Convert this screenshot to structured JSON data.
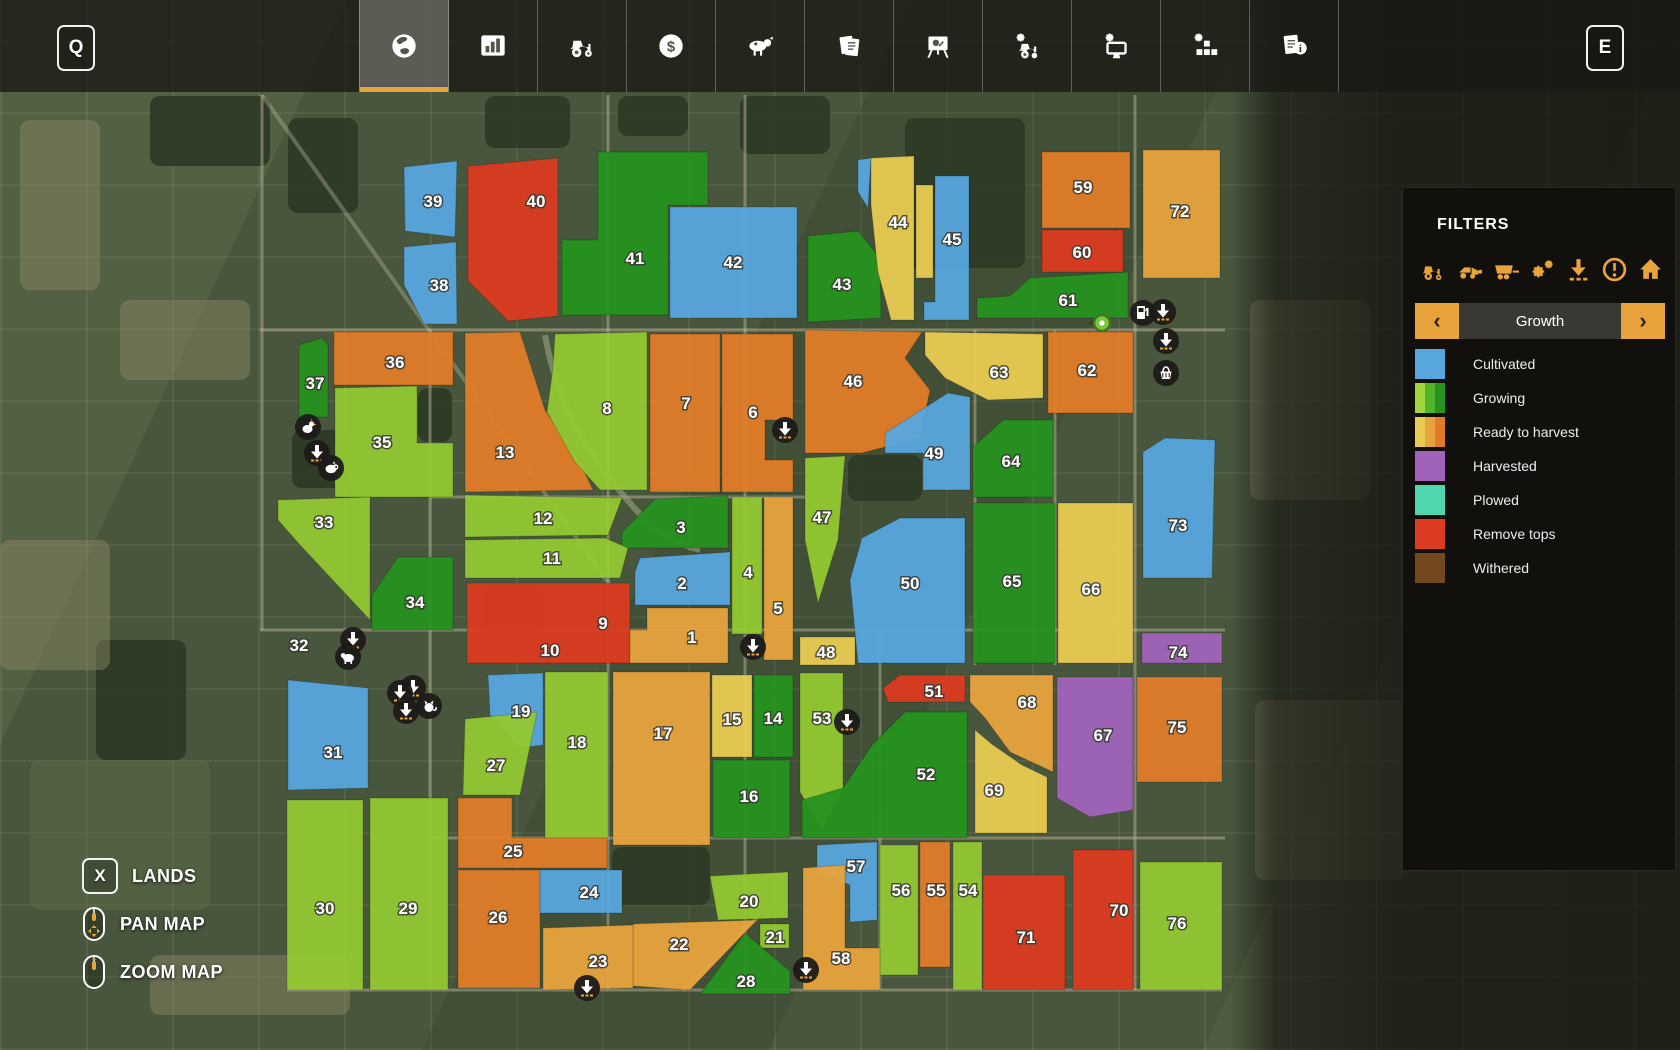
{
  "hotkeys": {
    "map": "Q",
    "menu": "E",
    "lands": "X"
  },
  "topbar": {
    "tabs": [
      {
        "icon": "globe",
        "active": true
      },
      {
        "icon": "bar-chart",
        "active": false
      },
      {
        "icon": "tractor",
        "active": false
      },
      {
        "icon": "dollar",
        "active": false
      },
      {
        "icon": "cow",
        "active": false
      },
      {
        "icon": "documents",
        "active": false
      },
      {
        "icon": "easel-chart",
        "active": false
      },
      {
        "icon": "tractor-gear",
        "active": false
      },
      {
        "icon": "monitor-gear",
        "active": false
      },
      {
        "icon": "blocks-gear",
        "active": false
      },
      {
        "icon": "document-info",
        "active": false
      }
    ]
  },
  "filters_panel": {
    "title": "FILTERS",
    "filter_icons": [
      "tractor",
      "loader",
      "trailer",
      "gears",
      "download",
      "alert",
      "house"
    ],
    "selector": {
      "label": "Growth",
      "prev": "‹",
      "next": "›"
    },
    "legend": [
      {
        "label": "Cultivated",
        "swatch": [
          "#57A7DE"
        ]
      },
      {
        "label": "Growing",
        "swatch": [
          "#9ED63B",
          "#52B42A",
          "#26921F"
        ]
      },
      {
        "label": "Ready to harvest",
        "swatch": [
          "#E9CB52",
          "#E8A33D",
          "#E07C28"
        ]
      },
      {
        "label": "Harvested",
        "swatch": [
          "#A163B9"
        ]
      },
      {
        "label": "Plowed",
        "swatch": [
          "#4FD6AE"
        ]
      },
      {
        "label": "Remove tops",
        "swatch": [
          "#DB3B20"
        ]
      },
      {
        "label": "Withered",
        "swatch": [
          "#74481F"
        ]
      }
    ]
  },
  "controls": [
    {
      "key": "X",
      "mouse": null,
      "label": "LANDS"
    },
    {
      "key": null,
      "mouse": "pan",
      "label": "PAN MAP"
    },
    {
      "key": null,
      "mouse": "zoom",
      "label": "ZOOM MAP"
    }
  ],
  "colors": {
    "cultivated": "#57A7DE",
    "growing_early": "#93C832",
    "growing_late": "#26921F",
    "ready_yellow": "#E9CB52",
    "ready_amber": "#E8A33D",
    "ready_orange": "#E07C28",
    "harvested": "#A163B9",
    "plowed": "#4FD6AE",
    "remove_tops": "#DB3B20",
    "withered": "#74481F",
    "accent": "#E8A33D"
  },
  "map": {
    "fields": [
      {
        "n": "39",
        "state": "cultivated",
        "d": "M404,167 L457,161 L455,237 L405,231 Z",
        "lp": [
          433,
          201
        ]
      },
      {
        "n": "38",
        "state": "cultivated",
        "d": "M404,247 L456,242 L457,324 L424,324 L404,285 Z",
        "lp": [
          439,
          285
        ]
      },
      {
        "n": "40",
        "state": "remove_tops",
        "d": "M468,166 L558,158 L558,316 L508,321 L468,281 Z",
        "lp": [
          536,
          201
        ]
      },
      {
        "n": "41",
        "state": "growing_late",
        "d": "M598,152 L708,152 L708,205 L668,205 L668,315 L562,315 L562,240 L598,240 Z",
        "lp": [
          635,
          258
        ]
      },
      {
        "n": "42",
        "state": "cultivated",
        "d": "M670,207 L797,207 L797,318 L670,318 Z",
        "lp": [
          733,
          262
        ]
      },
      {
        "n": "43",
        "state": "growing_late",
        "d": "M808,236 L858,231 L880,258 L881,318 L808,322 Z",
        "lp": [
          842,
          284
        ]
      },
      {
        "n": "44",
        "state": "ready_yellow",
        "d": "M871,158 L914,156 L914,320 L891,320 L878,272 L871,205 Z",
        "lp": [
          898,
          222
        ]
      },
      {
        "n": "",
        "state": "ready_yellow",
        "d": "M916,185 L933,185 L933,278 L916,278 Z",
        "lp": null
      },
      {
        "n": "45",
        "state": "cultivated",
        "d": "M935,176 L969,176 L969,320 L924,320 L924,302 L935,302 Z",
        "lp": [
          952,
          239
        ]
      },
      {
        "n": "",
        "state": "cultivated",
        "d": "M858,160 L871,158 L868,208 L858,192 Z",
        "lp": null
      },
      {
        "n": "59",
        "state": "ready_orange",
        "d": "M1042,152 L1130,152 L1130,228 L1042,228 Z",
        "lp": [
          1083,
          187
        ]
      },
      {
        "n": "60",
        "state": "remove_tops",
        "d": "M1042,230 L1123,230 L1123,272 L1042,272 Z",
        "lp": [
          1082,
          252
        ]
      },
      {
        "n": "61",
        "state": "growing_late",
        "d": "M977,298 L1010,296 L1030,278 L1128,272 L1128,318 L977,318 Z",
        "lp": [
          1068,
          300
        ]
      },
      {
        "n": "72",
        "state": "ready_amber",
        "d": "M1143,150 L1220,150 L1220,278 L1143,278 Z",
        "lp": [
          1180,
          211
        ]
      },
      {
        "n": "36",
        "state": "ready_orange",
        "d": "M334,332 L453,332 L453,385 L334,385 Z",
        "lp": [
          395,
          362
        ]
      },
      {
        "n": "37",
        "state": "growing_late",
        "d": "M299,345 L322,338 L328,345 L328,417 L299,417 Z",
        "lp": [
          315,
          383
        ]
      },
      {
        "n": "35",
        "state": "growing_early",
        "d": "M335,388 L417,386 L417,443 L453,443 L453,497 L335,497 Z",
        "lp": [
          382,
          442
        ]
      },
      {
        "n": "33",
        "state": "growing_early",
        "d": "M278,500 L370,497 L370,620 L300,545 L278,520 Z",
        "lp": [
          324,
          522
        ]
      },
      {
        "n": "34",
        "state": "growing_late",
        "d": "M372,595 L398,557 L453,557 L453,630 L372,630 Z",
        "lp": [
          415,
          602
        ]
      },
      {
        "n": "13",
        "state": "ready_orange",
        "d": "M465,333 L520,332 L545,410 L580,462 L593,490 L465,492 Z",
        "lp": [
          505,
          452
        ]
      },
      {
        "n": "8",
        "state": "growing_early",
        "d": "M555,334 L647,332 L647,490 L600,490 L575,462 L547,412 L553,368 Z",
        "lp": [
          607,
          408
        ]
      },
      {
        "n": "7",
        "state": "ready_orange",
        "d": "M650,334 L720,334 L720,492 L650,492 Z",
        "lp": [
          686,
          403
        ]
      },
      {
        "n": "6",
        "state": "ready_orange",
        "d": "M722,334 L793,334 L793,420 L765,420 L765,460 L793,460 L793,492 L722,492 Z",
        "lp": [
          753,
          412
        ]
      },
      {
        "n": "46",
        "state": "ready_orange",
        "d": "M805,330 L922,332 L905,358 L930,390 L920,438 L862,453 L805,453 Z",
        "lp": [
          853,
          381
        ]
      },
      {
        "n": "63",
        "state": "ready_yellow",
        "d": "M925,332 L1043,334 L1043,398 L988,400 L945,378 L925,355 Z",
        "lp": [
          999,
          372
        ]
      },
      {
        "n": "62",
        "state": "ready_orange",
        "d": "M1048,332 L1133,332 L1133,413 L1048,413 Z",
        "lp": [
          1087,
          370
        ]
      },
      {
        "n": "47",
        "state": "growing_early",
        "d": "M805,458 L845,456 L838,540 L818,603 L805,540 Z",
        "lp": [
          822,
          517
        ]
      },
      {
        "n": "49",
        "state": "cultivated",
        "d": "M948,393 L970,397 L970,490 L923,490 L923,453 L885,453 L885,433 Z",
        "lp": [
          934,
          453
        ]
      },
      {
        "n": "64",
        "state": "growing_late",
        "d": "M973,447 L1003,420 L1053,420 L1053,497 L973,497 Z",
        "lp": [
          1011,
          461
        ]
      },
      {
        "n": "50",
        "state": "cultivated",
        "d": "M862,538 L900,518 L965,518 L965,663 L858,663 L850,580 Z",
        "lp": [
          910,
          583
        ]
      },
      {
        "n": "65",
        "state": "growing_late",
        "d": "M973,503 L1055,503 L1055,663 L973,663 Z",
        "lp": [
          1012,
          581
        ]
      },
      {
        "n": "66",
        "state": "ready_yellow",
        "d": "M1058,503 L1133,503 L1133,663 L1058,663 Z",
        "lp": [
          1091,
          589
        ]
      },
      {
        "n": "73",
        "state": "cultivated",
        "d": "M1143,452 L1165,438 L1215,440 L1212,578 L1143,578 Z",
        "lp": [
          1178,
          525
        ]
      },
      {
        "n": "74",
        "state": "harvested",
        "d": "M1142,633 L1222,633 L1222,663 L1142,663 Z",
        "lp": [
          1178,
          652
        ]
      },
      {
        "n": "9",
        "state": "remove_tops",
        "d": "M467,583 L630,583 L630,663 L467,663 Z",
        "lp": [
          603,
          623
        ]
      },
      {
        "n": "10",
        "state": "remove_tops",
        "d": null,
        "lp": [
          550,
          650
        ]
      },
      {
        "n": "1",
        "state": "ready_amber",
        "d": "M630,630 L647,630 L647,608 L728,608 L728,663 L630,663 Z",
        "lp": [
          692,
          637
        ]
      },
      {
        "n": "2",
        "state": "cultivated",
        "d": "M640,558 L730,552 L730,605 L635,605 L635,572 Z",
        "lp": [
          682,
          583
        ]
      },
      {
        "n": "3",
        "state": "growing_late",
        "d": "M655,499 L728,496 L728,548 L622,548 L622,532 Z",
        "lp": [
          681,
          527
        ]
      },
      {
        "n": "12",
        "state": "growing_early",
        "d": "M465,495 L622,498 L608,535 L465,537 Z",
        "lp": [
          543,
          518
        ]
      },
      {
        "n": "11",
        "state": "growing_early",
        "d": "M465,540 L605,538 L628,548 L620,578 L465,578 Z",
        "lp": [
          552,
          558
        ]
      },
      {
        "n": "4",
        "state": "growing_early",
        "d": "M732,497 L762,497 L762,634 L732,634 Z",
        "lp": [
          748,
          572
        ]
      },
      {
        "n": "5",
        "state": "ready_amber",
        "d": "M764,497 L793,497 L793,660 L764,660 Z",
        "lp": [
          778,
          608
        ]
      },
      {
        "n": "48",
        "state": "ready_yellow",
        "d": "M800,637 L855,637 L855,665 L800,665 Z",
        "lp": [
          826,
          652
        ]
      },
      {
        "n": "19",
        "state": "cultivated",
        "d": "M488,675 L543,673 L543,745 L520,748 L490,715 Z",
        "lp": [
          521,
          711
        ]
      },
      {
        "n": "18",
        "state": "growing_early",
        "d": "M545,672 L608,672 L608,838 L545,838 Z",
        "lp": [
          577,
          742
        ]
      },
      {
        "n": "17",
        "state": "ready_amber",
        "d": "M613,672 L710,672 L710,845 L613,845 Z",
        "lp": [
          663,
          733
        ]
      },
      {
        "n": "15",
        "state": "ready_yellow",
        "d": "M712,675 L752,675 L752,757 L712,757 Z",
        "lp": [
          732,
          719
        ]
      },
      {
        "n": "14",
        "state": "growing_late",
        "d": "M754,675 L793,675 L793,757 L754,757 Z",
        "lp": [
          773,
          718
        ]
      },
      {
        "n": "16",
        "state": "growing_late",
        "d": "M713,760 L790,760 L790,838 L713,838 Z",
        "lp": [
          749,
          796
        ]
      },
      {
        "n": "53",
        "state": "growing_early",
        "d": "M800,673 L843,673 L843,790 L822,830 L800,792 Z",
        "lp": [
          822,
          718
        ]
      },
      {
        "n": "51",
        "state": "remove_tops",
        "d": "M883,688 L900,675 L965,675 L965,702 L888,702 Z",
        "lp": [
          934,
          691
        ]
      },
      {
        "n": "68",
        "state": "ready_amber",
        "d": "M970,675 L1053,675 L1053,772 L1010,752 L985,718 L970,702 Z",
        "lp": [
          1027,
          702
        ]
      },
      {
        "n": "67",
        "state": "harvested",
        "d": "M1057,677 L1133,677 L1133,810 L1090,817 L1057,798 Z",
        "lp": [
          1103,
          735
        ]
      },
      {
        "n": "75",
        "state": "ready_orange",
        "d": "M1137,677 L1222,677 L1222,782 L1137,782 Z",
        "lp": [
          1177,
          727
        ]
      },
      {
        "n": "69",
        "state": "ready_yellow",
        "d": "M975,730 L993,745 L1022,765 L1047,777 L1047,833 L975,833 Z",
        "lp": [
          994,
          790
        ]
      },
      {
        "n": "52",
        "state": "growing_late",
        "d": "M905,712 L967,712 L967,838 L802,838 L802,800 L843,788 L872,745 Z",
        "lp": [
          926,
          774
        ]
      },
      {
        "n": "20",
        "state": "growing_early",
        "d": "M710,876 L788,872 L788,918 L718,920 Z",
        "lp": [
          749,
          901
        ]
      },
      {
        "n": "21",
        "state": "growing_early",
        "d": "M760,924 L789,924 L789,948 L760,948 Z",
        "lp": [
          775,
          937
        ]
      },
      {
        "n": "22",
        "state": "ready_amber",
        "d": "M633,924 L757,920 L690,990 L633,986 Z",
        "lp": [
          679,
          944
        ]
      },
      {
        "n": "23",
        "state": "ready_amber",
        "d": "M543,928 L633,925 L633,988 L543,990 Z",
        "lp": [
          598,
          961
        ]
      },
      {
        "n": "24",
        "state": "cultivated",
        "d": "M540,870 L622,870 L622,913 L540,913 Z",
        "lp": [
          589,
          892
        ]
      },
      {
        "n": "25",
        "state": "ready_orange",
        "d": "M458,798 L512,798 L512,838 L607,838 L607,868 L458,868 Z",
        "lp": [
          513,
          851
        ]
      },
      {
        "n": "26",
        "state": "ready_orange",
        "d": "M458,870 L540,870 L540,988 L458,988 Z",
        "lp": [
          498,
          917
        ]
      },
      {
        "n": "27",
        "state": "growing_early",
        "d": "M465,719 L537,712 L520,795 L463,795 Z",
        "lp": [
          496,
          765
        ]
      },
      {
        "n": "28",
        "state": "growing_late",
        "d": "M745,933 L790,971 L790,994 L700,994 Z",
        "lp": [
          746,
          981
        ]
      },
      {
        "n": "29",
        "state": "growing_early",
        "d": "M370,798 L448,798 L448,990 L370,990 Z",
        "lp": [
          408,
          908
        ]
      },
      {
        "n": "30",
        "state": "growing_early",
        "d": "M287,800 L363,800 L363,990 L287,990 Z",
        "lp": [
          325,
          908
        ]
      },
      {
        "n": "31",
        "state": "cultivated",
        "d": "M288,680 L368,688 L368,788 L288,790 Z",
        "lp": [
          333,
          752
        ]
      },
      {
        "n": "32",
        "state": null,
        "d": null,
        "lp": [
          299,
          645
        ]
      },
      {
        "n": "57",
        "state": "cultivated",
        "d": "M817,845 L877,842 L877,920 L850,922 L850,885 L817,872 Z",
        "lp": [
          856,
          866
        ]
      },
      {
        "n": "56",
        "state": "growing_early",
        "d": "M880,845 L918,845 L918,975 L880,975 Z",
        "lp": [
          901,
          890
        ]
      },
      {
        "n": "55",
        "state": "ready_orange",
        "d": "M920,842 L950,842 L950,967 L920,967 Z",
        "lp": [
          936,
          890
        ]
      },
      {
        "n": "54",
        "state": "growing_early",
        "d": "M953,842 L982,842 L982,990 L953,990 Z",
        "lp": [
          968,
          890
        ]
      },
      {
        "n": "58",
        "state": "ready_amber",
        "d": "M803,868 L845,865 L845,948 L880,948 L880,990 L803,990 Z",
        "lp": [
          841,
          958
        ]
      },
      {
        "n": "71",
        "state": "remove_tops",
        "d": "M983,875 L1065,875 L1065,990 L983,990 Z",
        "lp": [
          1026,
          937
        ]
      },
      {
        "n": "70",
        "state": "remove_tops",
        "d": "M1073,850 L1133,850 L1133,990 L1073,990 Z",
        "lp": [
          1119,
          910
        ]
      },
      {
        "n": "76",
        "state": "growing_early",
        "d": "M1140,862 L1222,862 L1222,990 L1140,990 Z",
        "lp": [
          1177,
          923
        ]
      }
    ],
    "pois": [
      {
        "t": "chicken",
        "x": 308,
        "y": 427
      },
      {
        "t": "download",
        "x": 317,
        "y": 453
      },
      {
        "t": "pig",
        "x": 331,
        "y": 468
      },
      {
        "t": "download",
        "x": 353,
        "y": 640
      },
      {
        "t": "sheep",
        "x": 348,
        "y": 657
      },
      {
        "t": "download",
        "x": 413,
        "y": 688
      },
      {
        "t": "download",
        "x": 400,
        "y": 693
      },
      {
        "t": "download",
        "x": 406,
        "y": 711
      },
      {
        "t": "cat",
        "x": 429,
        "y": 706
      },
      {
        "t": "download",
        "x": 785,
        "y": 430
      },
      {
        "t": "download",
        "x": 753,
        "y": 647
      },
      {
        "t": "download",
        "x": 847,
        "y": 722
      },
      {
        "t": "download",
        "x": 806,
        "y": 970
      },
      {
        "t": "download",
        "x": 587,
        "y": 988
      },
      {
        "t": "fuel",
        "x": 1143,
        "y": 313
      },
      {
        "t": "download",
        "x": 1163,
        "y": 312
      },
      {
        "t": "download",
        "x": 1166,
        "y": 341
      },
      {
        "t": "basket",
        "x": 1166,
        "y": 373
      }
    ],
    "marker": {
      "x": 1102,
      "y": 323
    }
  }
}
